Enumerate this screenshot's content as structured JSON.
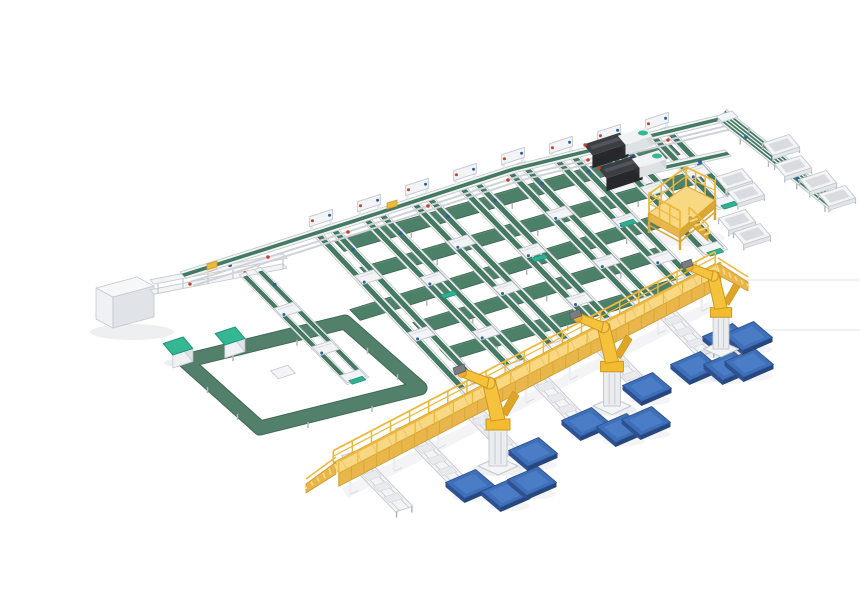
{
  "meta": {
    "label": "Isometric 3D render of an automated conveyor production line with green belt conveyors, two dark laminating machines, a yellow maintenance platform with stairs, a long yellow elevated gantry walkway, three yellow palletizing robot arms and stacks of blue panels",
    "canvas": {
      "w": 860,
      "h": 580
    }
  },
  "palette": {
    "bg": "#ffffff",
    "white_frame": "#f3f4f6",
    "frame_line": "#c2c8ce",
    "frame_shade": "#dde0e4",
    "plate": "#e8eaee",
    "belt_green": "#447a61",
    "belt_green_dark": "#35614e",
    "row_green": "#4d8069",
    "row_edge": "#3a624f",
    "row_hi": "#5d8c74",
    "loop_green": "#52806b",
    "loop_edge": "#3f6854",
    "mint": "#2eb091",
    "mint_dark": "#1f8f74",
    "teal_cube": "#35b793",
    "teal_cube_dark": "#23997c",
    "yellow_deck": "#f8d883",
    "yellow_mid": "#e9b64b",
    "yellow_rail": "#eeb838",
    "yellow_rib": "#d9a832",
    "yellow_dark": "#cf9732",
    "slat": "#ecc46e",
    "robot_yellow": "#f3bb2f",
    "robot_link": "#f5c23c",
    "robot_dark": "#cf9722",
    "balancer": "#dfa626",
    "pedestal": "#eaecee",
    "pedestal_line": "#c5cad0",
    "blue_top": "#3e6fb8",
    "blue_hi": "#4a7dc6",
    "blue_side_l": "#2d5191",
    "blue_side_r": "#26467e",
    "blue_stroke": "#2b528f",
    "machine_dark": "#3b3e43",
    "machine_front": "#26282b",
    "machine_side": "#2e3134",
    "machine_stripe": "#51555b",
    "red_dot": "#cc3b2e",
    "blue_dot": "#2e5fa3",
    "leg_gray": "#b0b6bc",
    "shadow": "rgba(110,120,135,0.12)",
    "shadow_soft": "rgba(110,120,135,0.08)",
    "streak": "#e7e9eb"
  },
  "scene": {
    "iso_e": [
      0.951,
      -0.309
    ],
    "iso_s": [
      0.643,
      0.766
    ],
    "lane_dir": [
      0.695,
      0.719
    ],
    "spine": [
      [
        140,
        256
      ],
      [
        310,
        202
      ],
      [
        470,
        150
      ],
      [
        688,
        97
      ]
    ],
    "r1_offset": 14,
    "red_dots": [
      [
        228,
        241
      ],
      [
        308,
        216
      ],
      [
        388,
        190
      ],
      [
        468,
        164
      ],
      [
        548,
        144
      ],
      [
        628,
        124
      ]
    ],
    "yellow_boxes": [
      [
        172,
        251
      ],
      [
        352,
        190
      ],
      [
        560,
        131
      ]
    ],
    "feeder": {
      "upper": [
        [
          112,
          266
        ],
        [
          245,
          240
        ]
      ],
      "lower": [
        [
          112,
          276
        ],
        [
          245,
          250
        ]
      ],
      "yellow_box": [
        170,
        252
      ],
      "blue_dot": [
        190,
        249
      ],
      "red_dots": [
        [
          150,
          268
        ],
        [
          205,
          257
        ]
      ]
    },
    "m0_top": [
      [
        56,
        272
      ],
      [
        97,
        261
      ],
      [
        114,
        270
      ],
      [
        73,
        281
      ]
    ],
    "m0_h": 31,
    "loop": {
      "ring": [
        [
          145,
          345
        ],
        [
          305,
          306
        ],
        [
          380,
          372
        ],
        [
          220,
          412
        ]
      ],
      "width": 13,
      "carriage": [
        243,
        356
      ]
    },
    "cubes": [
      [
        138,
        330
      ],
      [
        190,
        320
      ]
    ],
    "lane_l0": {
      "top": [
        210,
        255
      ],
      "bot": [
        318,
        365
      ],
      "carriages": [
        0.35,
        0.7
      ]
    },
    "lanes": [
      {
        "top": [
          281,
          211
        ],
        "bot": [
          438,
          378
        ],
        "carriages": [
          0.3,
          0.64
        ]
      },
      {
        "top": [
          329,
          196
        ],
        "bot": [
          483,
          355
        ],
        "carriages": [
          0.42,
          0.76
        ],
        "mid_mint": true
      },
      {
        "top": [
          377,
          180
        ],
        "bot": [
          526,
          334
        ],
        "carriages": [
          0.3,
          0.6
        ]
      },
      {
        "top": [
          425,
          165
        ],
        "bot": [
          568,
          313
        ],
        "carriages": [
          0.47,
          0.8
        ],
        "mid_mint": true
      },
      {
        "top": [
          473,
          149
        ],
        "bot": [
          610,
          291
        ],
        "carriages": [
          0.34,
          0.68
        ]
      },
      {
        "top": [
          521,
          138
        ],
        "bot": [
          650,
          271
        ],
        "carriages": [
          0.5,
          0.78
        ],
        "mid_mint": true
      },
      {
        "top": [
          569,
          126
        ],
        "bot": [
          676,
          237
        ],
        "carriages": [
          0.42
        ]
      },
      {
        "top": [
          617,
          114
        ],
        "bot": [
          690,
          190
        ],
        "carriages": [
          0.55
        ]
      }
    ],
    "rows": [
      [
        [
          299,
          230
        ],
        [
          635,
          133
        ]
      ],
      [
        [
          325,
          257
        ],
        [
          660,
          160
        ]
      ],
      [
        [
          315,
          299
        ],
        [
          648,
          196
        ]
      ],
      [
        [
          378,
          312
        ],
        [
          625,
          236
        ]
      ],
      [
        [
          405,
          339
        ],
        [
          640,
          268
        ]
      ]
    ],
    "e2": [
      [
        575,
        162
      ],
      [
        688,
        137
      ]
    ],
    "e2_box": [
      612,
      150
    ],
    "e2_dot": [
      660,
      146
    ],
    "d1": {
      "a": [
        682,
        99
      ],
      "b": [
        795,
        189
      ]
    },
    "d1_corner": [
      [
        676,
        100
      ],
      [
        692,
        95
      ],
      [
        698,
        101
      ],
      [
        682,
        106
      ]
    ],
    "d1_specks": [
      [
        706,
        121
      ],
      [
        733,
        142
      ],
      [
        757,
        162
      ]
    ],
    "carts": [
      [
        694,
        163
      ],
      [
        706,
        177
      ],
      [
        697,
        204
      ],
      [
        712,
        218
      ],
      [
        741,
        129
      ],
      [
        753,
        150
      ],
      [
        778,
        165
      ],
      [
        797,
        180
      ]
    ],
    "machines": [
      {
        "c": [
          566,
          128
        ],
        "tail": [
          595,
          120
        ],
        "teal": [
          603,
          117
        ]
      },
      {
        "c": [
          580,
          151
        ],
        "tail": [
          609,
          143
        ],
        "teal": [
          617,
          140
        ]
      }
    ],
    "platform": {
      "deck": [
        [
          609,
          197
        ],
        [
          646,
          170
        ],
        [
          675,
          184
        ],
        [
          640,
          214
        ]
      ],
      "rail_h": 19,
      "leg_h": 20,
      "stairs": {
        "a": [
          649,
          199
        ],
        "b": [
          668,
          217
        ]
      }
    },
    "outfeeds": [
      [
        310,
        437
      ],
      [
        364,
        410
      ],
      [
        420,
        382
      ],
      [
        484,
        348
      ],
      [
        548,
        315
      ],
      [
        612,
        282
      ]
    ],
    "outfeed_len": 78,
    "gantry": {
      "a": [
        296,
        452
      ],
      "b": [
        678,
        253
      ],
      "ramp_left": [
        [
          296,
          452
        ],
        [
          266,
          472
        ]
      ],
      "ramp_right": [
        [
          678,
          253
        ],
        [
          708,
          270
        ]
      ]
    },
    "robots": [
      {
        "base": [
          458,
          450
        ],
        "s": 1.0
      },
      {
        "base": [
          572,
          390
        ],
        "s": 0.95
      },
      {
        "base": [
          681,
          333
        ],
        "s": 0.88
      }
    ],
    "pallets": [
      [
        430,
        468
      ],
      [
        466,
        477
      ],
      [
        492,
        465
      ],
      [
        493,
        436
      ],
      [
        546,
        406
      ],
      [
        581,
        412
      ],
      [
        606,
        405
      ],
      [
        607,
        371
      ],
      [
        655,
        350
      ],
      [
        688,
        350
      ],
      [
        709,
        347
      ],
      [
        687,
        322
      ],
      [
        708,
        320
      ]
    ],
    "shadow_lines": [
      [
        [
          700,
          264
        ],
        [
          858,
          264
        ]
      ],
      [
        [
          718,
          314
        ],
        [
          858,
          314
        ]
      ]
    ]
  }
}
